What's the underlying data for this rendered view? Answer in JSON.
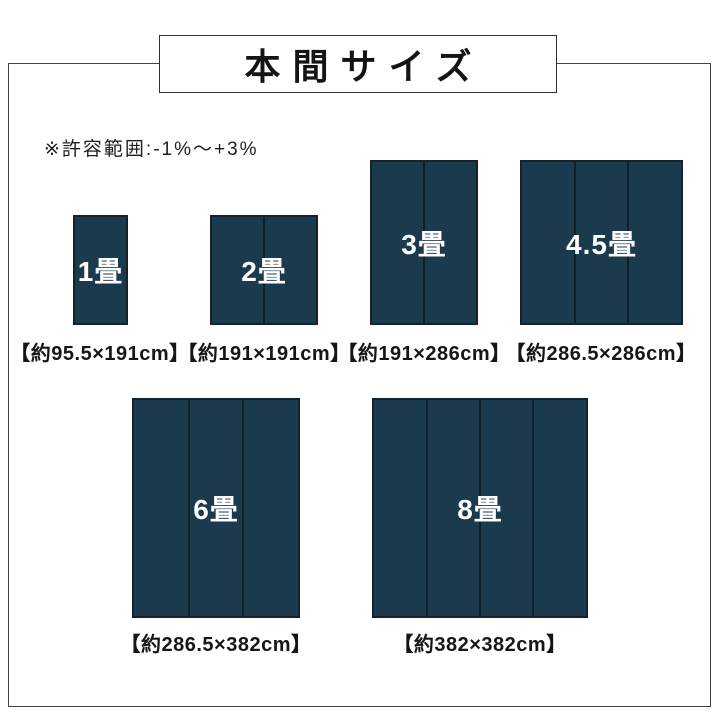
{
  "title": {
    "text": "本間サイズ"
  },
  "note": {
    "text": "※許容範囲:-1%〜+3%"
  },
  "mats": [
    {
      "label": "1畳",
      "caption": "【約95.5×191cm】",
      "panels": 1
    },
    {
      "label": "2畳",
      "caption": "【約191×191cm】",
      "panels": 2
    },
    {
      "label": "3畳",
      "caption": "【約191×286cm】",
      "panels": 2
    },
    {
      "label": "4.5畳",
      "caption": "【約286.5×286cm】",
      "panels": 3
    },
    {
      "label": "6畳",
      "caption": "【約286.5×382cm】",
      "panels": 3
    },
    {
      "label": "8畳",
      "caption": "【約382×382cm】",
      "panels": 4
    }
  ],
  "colors": {
    "mat_fill": "#1c3a4e",
    "mat_border": "#13222c",
    "panel_divider": "#0f1f2a",
    "mat_label_text": "#ffffff",
    "frame_border": "#444444",
    "text": "#1f1f1f",
    "background": "#ffffff"
  }
}
